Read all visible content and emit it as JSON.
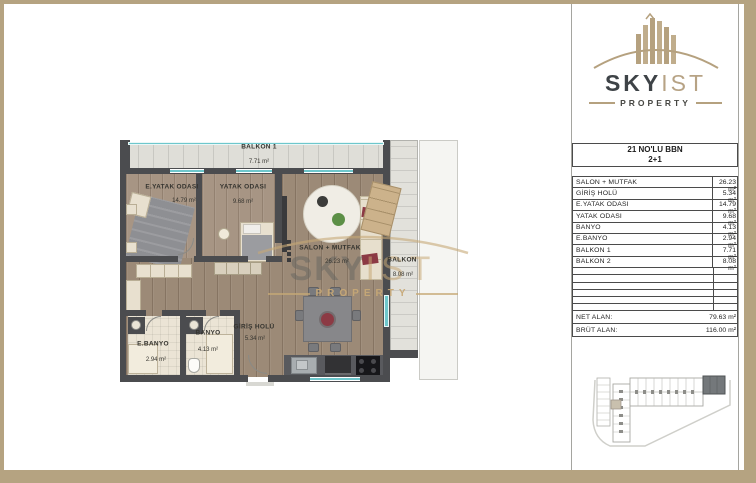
{
  "brand": {
    "sky": "SKY",
    "ist": "IST",
    "property": "PROPERTY"
  },
  "unit_card": {
    "title": "21 NO'LU BBN",
    "type": "2+1"
  },
  "area_table": {
    "rows": [
      {
        "label": "SALON + MUTFAK",
        "value": "26.23 m²"
      },
      {
        "label": "GİRİŞ HOLÜ",
        "value": "5.34 m²"
      },
      {
        "label": "E.YATAK ODASI",
        "value": "14.79 m²"
      },
      {
        "label": "YATAK ODASI",
        "value": "9.68 m²"
      },
      {
        "label": "BANYO",
        "value": "4.13 m²"
      },
      {
        "label": "E.BANYO",
        "value": "2.94 m²"
      },
      {
        "label": "BALKON 1",
        "value": "7.71 m²"
      },
      {
        "label": "BALKON 2",
        "value": "8.08 m²"
      }
    ],
    "totals": [
      {
        "label": "NET ALAN:",
        "value": "79.63 m²"
      },
      {
        "label": "BRÜT ALAN:",
        "value": "116.00 m²"
      }
    ]
  },
  "floorplan": {
    "labels": {
      "balkon1": {
        "name": "BALKON 1",
        "area": "7.71 m²"
      },
      "eyatak": {
        "name": "E.YATAK ODASI",
        "area": "14.79 m²"
      },
      "yatak": {
        "name": "YATAK ODASI",
        "area": "9.68 m²"
      },
      "salon": {
        "name": "SALON + MUTFAK",
        "area": "26.23 m²"
      },
      "giris": {
        "name": "GİRİŞ HOLÜ",
        "area": "5.34 m²"
      },
      "banyo": {
        "name": "BANYO",
        "area": "4.13 m²"
      },
      "ebanyo": {
        "name": "E.BANYO",
        "area": "2.94 m²"
      },
      "balkon2": {
        "name": "BALKON",
        "area": "8.08 m²"
      }
    },
    "watermark": {
      "sky": "SKY",
      "ist": "IST",
      "property": "PROPERTY"
    }
  },
  "colors": {
    "frame": "#b5a381",
    "logo_dark": "#3e4347",
    "logo_tan": "#b5a17f",
    "wall": "#4b4c4f",
    "wood": "#9c8a77",
    "balcony_tile": "#dfded8",
    "glass": "#6ec7cc",
    "bath_tile": "#ebe4d5",
    "accent_red": "#8c3a44",
    "site_highlight": "#74787b"
  }
}
